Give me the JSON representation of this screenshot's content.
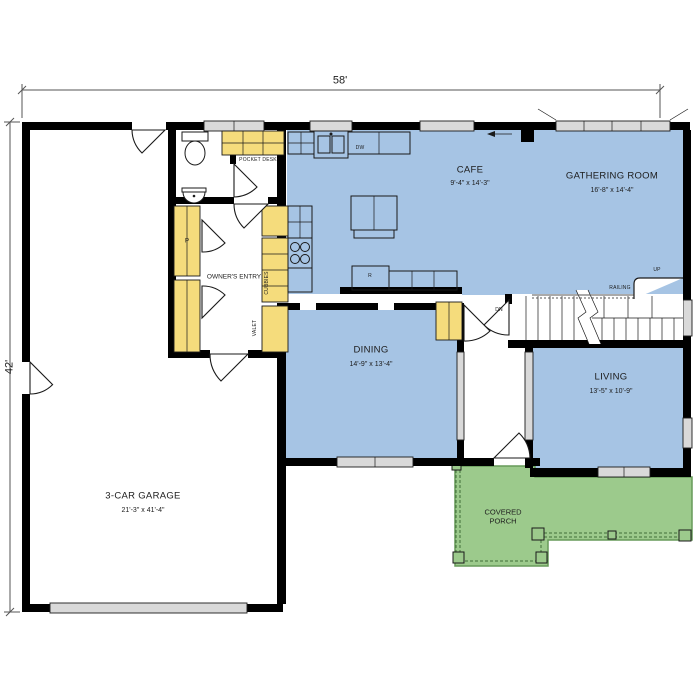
{
  "plan": {
    "overall_width": "58'",
    "overall_height": "42'",
    "rooms": {
      "cafe": {
        "name": "CAFE",
        "dims": "9'-4\" x 14'-3\""
      },
      "gathering": {
        "name": "GATHERING ROOM",
        "dims": "16'-8\" x 14'-4\""
      },
      "dining": {
        "name": "DINING",
        "dims": "14'-9\" x 13'-4\""
      },
      "living": {
        "name": "LIVING",
        "dims": "13'-5\" x 10'-9\""
      },
      "garage": {
        "name": "3-CAR GARAGE",
        "dims": "21'-3\" x 41'-4\""
      },
      "owners_entry": {
        "name": "OWNER'S ENTRY"
      },
      "covered_porch": {
        "name": "COVERED PORCH"
      },
      "pocket_desk": {
        "name": "POCKET DESK"
      }
    },
    "annotations": {
      "dishwasher": "DW",
      "range": "R",
      "pantry": "P",
      "cubbies": "CUBBIES",
      "valet": "VALET",
      "up": "UP",
      "down": "DN",
      "railing": "RAILING"
    },
    "colors": {
      "living_space": "#a6c4e4",
      "porch": "#9cca8c",
      "cabinetry": "#f5dc7c",
      "walls": "#000000",
      "windows": "#d9d9d9",
      "background": "#ffffff"
    }
  }
}
